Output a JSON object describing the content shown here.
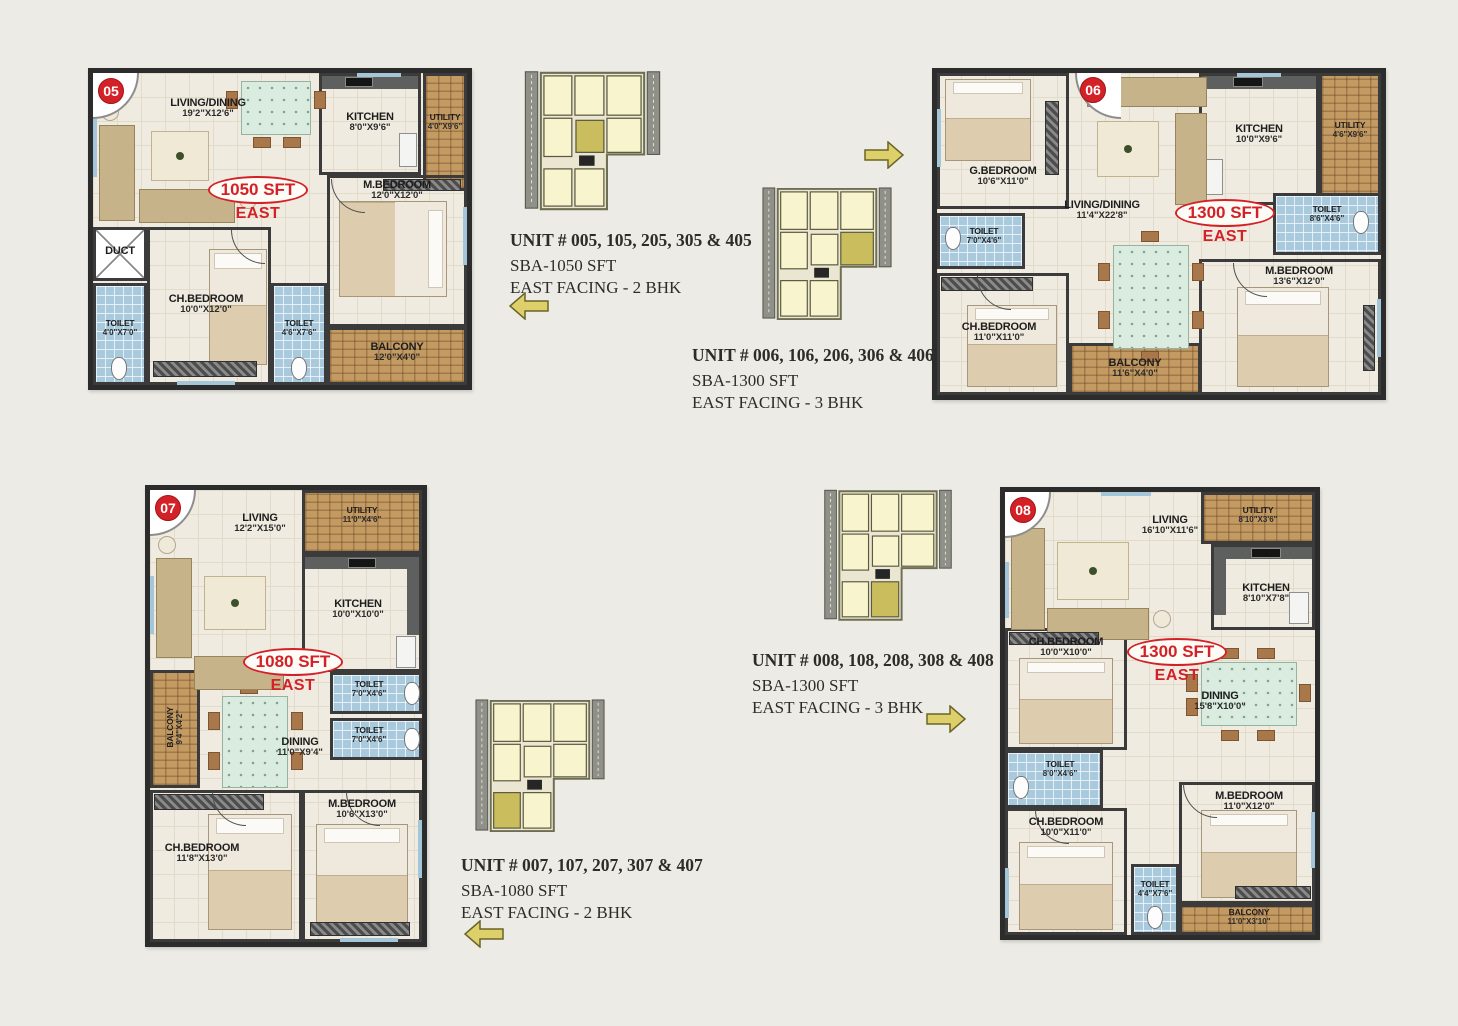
{
  "page": {
    "background": "#ecebe5"
  },
  "colors": {
    "accent_red": "#d42127",
    "arrow_yellow": "#ddd06a",
    "keyplan_highlight": "#c9bd5e",
    "toilet_blue": "#a9cadd",
    "balcony_brick": "#c49a63",
    "wall_dark": "#2c2c2c"
  },
  "units": [
    {
      "badge": "05",
      "area": "1050 SFT",
      "facing": "EAST",
      "rooms": {
        "living_dining": {
          "name": "LIVING/DINING",
          "dims": "19'2\"X12'6\""
        },
        "kitchen": {
          "name": "KITCHEN",
          "dims": "8'0\"X9'6\""
        },
        "utility": {
          "name": "UTILITY",
          "dims": "4'0\"X9'6\""
        },
        "duct": {
          "name": "DUCT",
          "dims": ""
        },
        "toilet1": {
          "name": "TOILET",
          "dims": "4'0\"X7'0\""
        },
        "ch_bedroom": {
          "name": "CH.BEDROOM",
          "dims": "10'0\"X12'0\""
        },
        "toilet2": {
          "name": "TOILET",
          "dims": "4'6\"X7'6\""
        },
        "m_bedroom": {
          "name": "M.BEDROOM",
          "dims": "12'0\"X12'0\""
        },
        "balcony": {
          "name": "BALCONY",
          "dims": "12'0\"X4'0\""
        }
      },
      "info": {
        "line1": "UNIT #  005, 105, 205, 305 & 405",
        "line2": "SBA-1050 SFT",
        "line3": "EAST FACING - 2 BHK"
      },
      "arrow_direction": "left"
    },
    {
      "badge": "06",
      "area": "1300 SFT",
      "facing": "EAST",
      "rooms": {
        "g_bedroom": {
          "name": "G.BEDROOM",
          "dims": "10'6\"X11'0\""
        },
        "kitchen": {
          "name": "KITCHEN",
          "dims": "10'0\"X9'6\""
        },
        "utility": {
          "name": "UTILITY",
          "dims": "4'6\"X9'6\""
        },
        "toilet1": {
          "name": "TOILET",
          "dims": "7'0\"X4'6\""
        },
        "living_dining": {
          "name": "LIVING/DINING",
          "dims": "11'4\"X22'8\""
        },
        "toilet2": {
          "name": "TOILET",
          "dims": "8'6\"X4'6\""
        },
        "m_bedroom": {
          "name": "M.BEDROOM",
          "dims": "13'6\"X12'0\""
        },
        "ch_bedroom": {
          "name": "CH.BEDROOM",
          "dims": "11'0\"X11'0\""
        },
        "balcony": {
          "name": "BALCONY",
          "dims": "11'6\"X4'0\""
        }
      },
      "info": {
        "line1": "UNIT #  006, 106, 206, 306 & 406",
        "line2": "SBA-1300 SFT",
        "line3": "EAST FACING - 3 BHK"
      },
      "arrow_direction": "right"
    },
    {
      "badge": "07",
      "area": "1080 SFT",
      "facing": "EAST",
      "rooms": {
        "living": {
          "name": "LIVING",
          "dims": "12'2\"X15'0\""
        },
        "utility": {
          "name": "UTILITY",
          "dims": "11'0\"X4'6\""
        },
        "kitchen": {
          "name": "KITCHEN",
          "dims": "10'0\"X10'0\""
        },
        "balcony": {
          "name": "BALCONY",
          "dims": "9'4\"X4'2\""
        },
        "dining": {
          "name": "DINING",
          "dims": "11'0\"X9'4\""
        },
        "toilet1": {
          "name": "TOILET",
          "dims": "7'0\"X4'6\""
        },
        "toilet2": {
          "name": "TOILET",
          "dims": "7'0\"X4'6\""
        },
        "ch_bedroom": {
          "name": "CH.BEDROOM",
          "dims": "11'8\"X13'0\""
        },
        "m_bedroom": {
          "name": "M.BEDROOM",
          "dims": "10'6\"X13'0\""
        }
      },
      "info": {
        "line1": "UNIT #  007, 107, 207, 307 & 407",
        "line2": "SBA-1080 SFT",
        "line3": "EAST FACING - 2 BHK"
      },
      "arrow_direction": "left"
    },
    {
      "badge": "08",
      "area": "1300 SFT",
      "facing": "EAST",
      "rooms": {
        "living": {
          "name": "LIVING",
          "dims": "16'10\"X11'6\""
        },
        "utility": {
          "name": "UTILITY",
          "dims": "8'10\"X3'6\""
        },
        "kitchen": {
          "name": "KITCHEN",
          "dims": "8'10\"X7'8\""
        },
        "ch_bedroom1": {
          "name": "CH.BEDROOM",
          "dims": "10'0\"X10'0\""
        },
        "dining": {
          "name": "DINING",
          "dims": "15'8\"X10'0\""
        },
        "toilet1": {
          "name": "TOILET",
          "dims": "8'0\"X4'6\""
        },
        "ch_bedroom2": {
          "name": "CH.BEDROOM",
          "dims": "10'0\"X11'0\""
        },
        "m_bedroom": {
          "name": "M.BEDROOM",
          "dims": "11'0\"X12'0\""
        },
        "toilet2": {
          "name": "TOILET",
          "dims": "4'4\"X7'6\""
        },
        "balcony": {
          "name": "BALCONY",
          "dims": "11'0\"X3'10\""
        }
      },
      "info": {
        "line1": "UNIT #  008, 108, 208, 308 & 408",
        "line2": "SBA-1300 SFT",
        "line3": "EAST FACING - 3 BHK"
      },
      "arrow_direction": "right"
    }
  ]
}
